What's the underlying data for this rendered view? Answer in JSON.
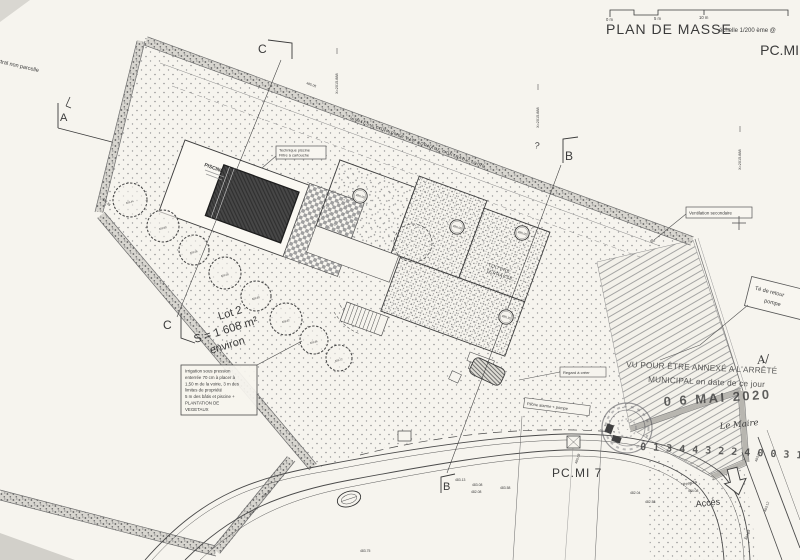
{
  "header": {
    "title": "PLAN DE MASSE",
    "scale_note": "échelle 1/200 ème @",
    "sheet_code": "PC.MI",
    "scale_bar": {
      "m0": "0 m",
      "m5": "5 m",
      "m10": "10 m"
    }
  },
  "watermark": "PC.MI 7",
  "corner_note": "cadastral non parcelle",
  "boundary_note": "LIMITES A CONFIRMER PAR BORNAGE CONTRADICTOIRE",
  "lot": {
    "name": "Lot 2",
    "area": "S = 1 608 m²",
    "suffix": "environ"
  },
  "irrigation": {
    "l1": "Irrigation sous pression",
    "l2": "enterrée 70 cm à placer à",
    "l3": "1,50 m de la voirie, 3 m des",
    "l4": "limites de propriété",
    "l5": "5 m des bâtis et piscine +",
    "l6": "PLANTATION DE",
    "l7": "VEGETAUX"
  },
  "pool": {
    "label": "PISCINE",
    "tech1": "Technique piscine",
    "tech2": "Filtre à cartouche"
  },
  "roof": {
    "l1": "TOITURE",
    "l2": "TERRASSE"
  },
  "notes": {
    "ventilation": "Ventilation secondaire",
    "regard": "Regard à créer",
    "pilone": "Pilône alarme + pompe",
    "te1": "Té de retour",
    "te2": "pompe",
    "acces": "Accès",
    "pergola": "Pergola",
    "question": "?"
  },
  "sections": {
    "a": "A",
    "b": "B",
    "c": "C"
  },
  "stamp": {
    "line1": "VU POUR ÊTRE ANNEXÉ A L'ARRÊTÉ",
    "line2": "MUNICIPAL en date de ce jour",
    "date": "0 6 MAI 2020",
    "signer": "Le Maire",
    "mark": "A/",
    "number": "0 1 3 4 4 3 2 2 4 0 0 3 1 0 2"
  },
  "coords": {
    "x1": "X=2015.888",
    "x2": "X=2015.888",
    "x3": "X=2015.888"
  },
  "levels": {
    "circled": [
      "486.00",
      "486.00",
      "485.05",
      "485.35"
    ],
    "trees": [
      "483.44",
      "483.50",
      "483.56",
      "483.58",
      "483.60",
      "483.62",
      "483.66",
      "483.72"
    ],
    "spots": [
      "485.05",
      "483.36",
      "483.13",
      "483.08",
      "482.08",
      "483.58",
      "485.08",
      "482.04",
      "482.58",
      "483.48",
      "483.71",
      "483.75",
      "483.04",
      "483.12",
      "482.88",
      "484.08"
    ]
  }
}
